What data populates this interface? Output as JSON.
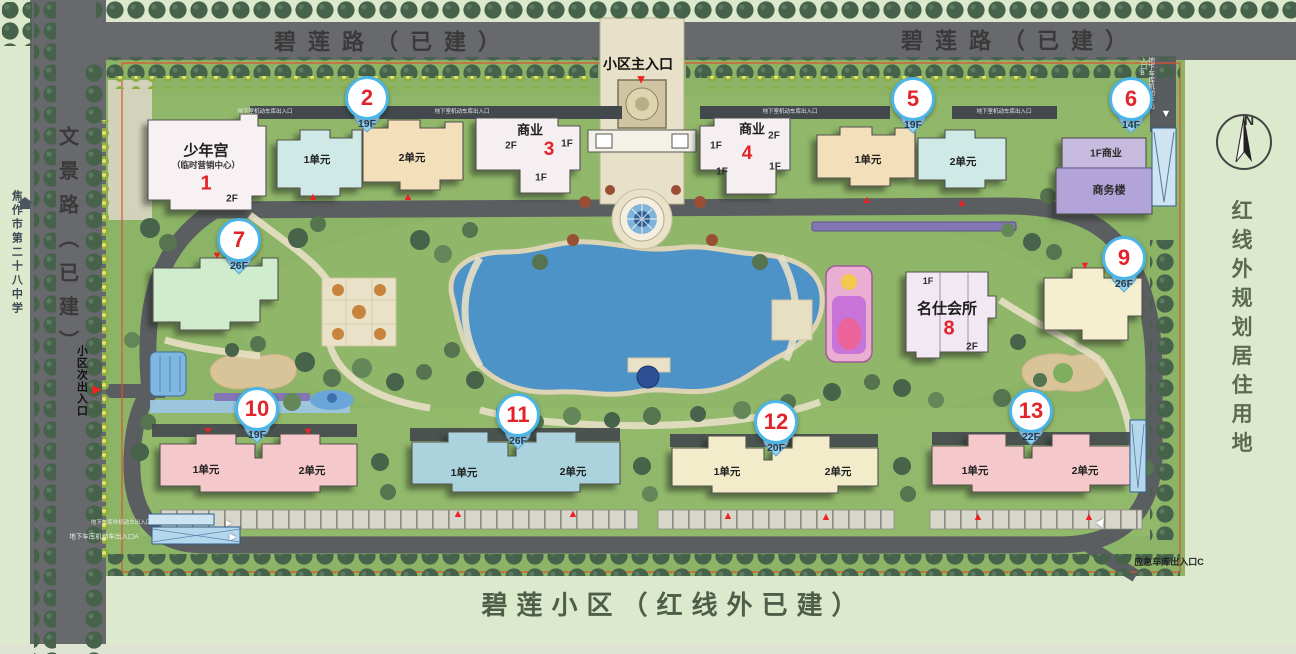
{
  "palette": {
    "bg": "#dde9cd",
    "road": "#67696c",
    "site_green": "#8cb466",
    "lake_blue": "#4e93c8",
    "marker_ring": "#4ab5e8",
    "marker_red": "#e2242a",
    "beach": "#e9e2c8",
    "boundary_red": "#e0512f"
  },
  "roads": {
    "top_left_label": "碧莲路（已建）",
    "top_right_label": "碧莲路（已建）",
    "left_label": "文景路（已建）"
  },
  "zones": {
    "right_label": "红线外规划居住用地",
    "bottom_label": "碧莲小区（红线外已建）",
    "school_label": "焦作市第二十八中学"
  },
  "compass": {
    "label": "N"
  },
  "entrances": {
    "main": "小区主入口",
    "secondary": "小区次出入口",
    "emergency": "应急车库出入口C",
    "garage_a": "地下车库机动车出入口A",
    "garage_nonmotor": "地下车库非机动车出入口",
    "garage_b": "地下车库机动车出入口B",
    "garage_top": "地下室机动车库出入口"
  },
  "buildings": {
    "b1": {
      "name": "少年宫",
      "subtitle": "（临时营销中心）",
      "num": "1",
      "floor": "2F"
    },
    "b2": {
      "unit1": "1单元",
      "unit2": "2单元"
    },
    "b3": {
      "name": "商业",
      "num": "3",
      "floor_left": "2F",
      "floor_right": "1F",
      "floor_low": "1F"
    },
    "b4": {
      "name": "商业",
      "num": "4",
      "floor_left": "1F",
      "floor_right": "2F",
      "floor_mid": "1F",
      "floor_low": "1F"
    },
    "b5": {
      "unit1": "1单元",
      "unit2": "2单元"
    },
    "b6": {
      "retail": "1F商业",
      "name": "商务楼"
    },
    "b8": {
      "name": "名仕会所",
      "num": "8",
      "floor_top": "1F",
      "floor_low": "2F"
    },
    "b10": {
      "unit1": "1单元",
      "unit2": "2单元"
    },
    "b11": {
      "unit1": "1单元",
      "unit2": "2单元"
    },
    "b12": {
      "unit1": "1单元",
      "unit2": "2单元"
    },
    "b13": {
      "unit1": "1单元",
      "unit2": "2单元"
    }
  },
  "markers": [
    {
      "num": "2",
      "floor": "19F"
    },
    {
      "num": "5",
      "floor": "19F"
    },
    {
      "num": "6",
      "floor": "14F"
    },
    {
      "num": "7",
      "floor": "26F"
    },
    {
      "num": "9",
      "floor": "26F"
    },
    {
      "num": "10",
      "floor": "19F"
    },
    {
      "num": "11",
      "floor": "26F"
    },
    {
      "num": "12",
      "floor": "20F"
    },
    {
      "num": "13",
      "floor": "22F"
    }
  ]
}
